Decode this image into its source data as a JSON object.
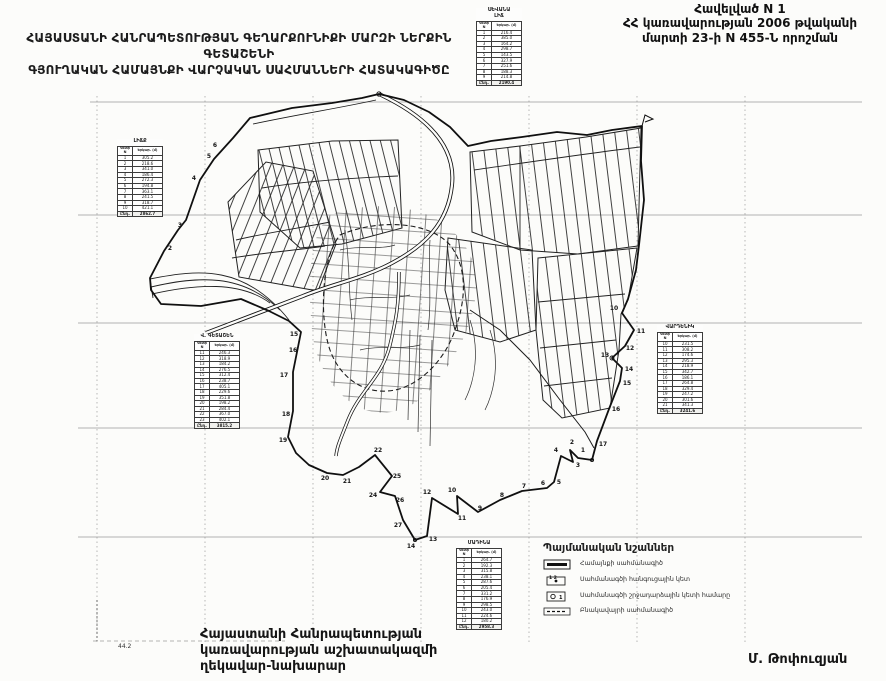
{
  "document": {
    "annex": {
      "line1": "Հավելված N 1",
      "line2": "ՀՀ կառավարության 2006 թվականի",
      "line3": "մարտի 23-ի N 455-Ն որոշման"
    },
    "title": {
      "line1": "ՀԱՅԱՍՏԱՆԻ ՀԱՆՐԱՊԵՏՈՒԹՅԱՆ ԳԵՂԱՐՔՈՒՆԻՔԻ ՄԱՐԶԻ ՆԵՐՔԻՆ ԳԵՏԱՇԵՆԻ",
      "line2": "ԳՅՈՒՂԱԿԱՆ ՀԱՄԱՅՆՔԻ ՎԱՐՉԱԿԱՆ ՍԱՀՄԱՆՆԵՐԻ ՀԱՏԱԿԱԳԻԾԸ"
    },
    "signature": {
      "line1": "Հայաստանի Հանրապետության",
      "line2": "կառավարության աշխատակազմի",
      "line3": "ղեկավար-նախարար",
      "name": "Մ. Թոփուզյան"
    },
    "scale_mark": "44.2",
    "ink_color": "#141414",
    "paper_color": "#fcfcfa",
    "grid_color": "#9a9a9a"
  },
  "legend": {
    "title": "Պայմանական նշաններ",
    "items": [
      {
        "symbol": "community-boundary-line",
        "label": "Համայնքի սահմանագիծ",
        "symbol_digits": ""
      },
      {
        "symbol": "boundary-node-point",
        "label": "Սահմանագծի հանգուցային կետ",
        "symbol_digits": "1 2"
      },
      {
        "symbol": "boundary-turn-point-number",
        "label": "Սահմանագծի շրջադարձային կետի համարը",
        "symbol_digits": "1"
      },
      {
        "symbol": "settlement-boundary-line",
        "label": "Բնակավայրի սահմանագիծ",
        "symbol_digits": ""
      }
    ]
  },
  "coordinate_tables": [
    {
      "id": "t-north",
      "x": 476,
      "y": 8,
      "title_lines": [
        "ՍԵՎԱՆԱ",
        "ԼԻՃ"
      ],
      "headers": [
        "Կետի N",
        "Երկար. (մ)"
      ],
      "rows": [
        [
          "1",
          "216.4"
        ],
        [
          "2",
          "385.0"
        ],
        [
          "3",
          "164.2"
        ],
        [
          "4",
          "298.7"
        ],
        [
          "5",
          "143.5"
        ],
        [
          "6",
          "327.9"
        ],
        [
          "7",
          "251.6"
        ],
        [
          "8",
          "188.3"
        ],
        [
          "9",
          "214.8"
        ]
      ],
      "total": [
        "Ընդ.",
        "2190.4"
      ]
    },
    {
      "id": "t-west-upper",
      "x": 117,
      "y": 139,
      "title_lines": [
        "ԼԻՃՔ"
      ],
      "headers": [
        "Կետի N",
        "Երկար. (մ)"
      ],
      "rows": [
        [
          "1",
          "305.2"
        ],
        [
          "2",
          "218.6"
        ],
        [
          "3",
          "341.0"
        ],
        [
          "4",
          "186.4"
        ],
        [
          "5",
          "272.3"
        ],
        [
          "6",
          "194.8"
        ],
        [
          "7",
          "363.1"
        ],
        [
          "8",
          "241.5"
        ],
        [
          "9",
          "318.7"
        ],
        [
          "10",
          "421.1"
        ]
      ],
      "total": [
        "Ընդ.",
        "2862.7"
      ]
    },
    {
      "id": "t-west-mid",
      "x": 194,
      "y": 334,
      "title_lines": [
        "Վ. ԳԵՏԱՇԵՆ"
      ],
      "headers": [
        "Կետի N",
        "Երկար. (մ)"
      ],
      "rows": [
        [
          "11",
          "246.3"
        ],
        [
          "12",
          "318.9"
        ],
        [
          "13",
          "184.2"
        ],
        [
          "14",
          "276.5"
        ],
        [
          "15",
          "312.4"
        ],
        [
          "16",
          "238.7"
        ],
        [
          "17",
          "405.1"
        ],
        [
          "18",
          "229.6"
        ],
        [
          "19",
          "351.8"
        ],
        [
          "20",
          "198.2"
        ],
        [
          "21",
          "284.4"
        ],
        [
          "22",
          "367.0"
        ],
        [
          "23",
          "402.1"
        ]
      ],
      "total": [
        "Ընդ.",
        "3815.2"
      ]
    },
    {
      "id": "t-east",
      "x": 657,
      "y": 325,
      "title_lines": [
        "ՎԱՐԴԵՆԻԿ"
      ],
      "headers": [
        "Կետի N",
        "Երկար. (մ)"
      ],
      "rows": [
        [
          "10",
          "231.5"
        ],
        [
          "11",
          "308.2"
        ],
        [
          "12",
          "174.6"
        ],
        [
          "13",
          "295.3"
        ],
        [
          "14",
          "218.9"
        ],
        [
          "15",
          "342.7"
        ],
        [
          "16",
          "186.1"
        ],
        [
          "17",
          "264.8"
        ],
        [
          "18",
          "329.4"
        ],
        [
          "19",
          "247.2"
        ],
        [
          "20",
          "301.6"
        ],
        [
          "21",
          "341.3"
        ]
      ],
      "total": [
        "Ընդ.",
        "3241.6"
      ]
    },
    {
      "id": "t-south",
      "x": 456,
      "y": 541,
      "title_lines": [
        "ՄԱԴԻՆԱ"
      ],
      "headers": [
        "Կետի N",
        "Երկար. (մ)"
      ],
      "rows": [
        [
          "1",
          "264.7"
        ],
        [
          "2",
          "192.3"
        ],
        [
          "3",
          "315.8"
        ],
        [
          "4",
          "238.1"
        ],
        [
          "5",
          "287.6"
        ],
        [
          "6",
          "205.4"
        ],
        [
          "7",
          "331.2"
        ],
        [
          "8",
          "176.9"
        ],
        [
          "9",
          "298.5"
        ],
        [
          "10",
          "243.0"
        ],
        [
          "11",
          "224.6"
        ],
        [
          "12",
          "180.2"
        ]
      ],
      "total": [
        "Ընդ.",
        "2958.3"
      ]
    }
  ],
  "boundary_point_labels": [
    {
      "n": "1",
      "x": 583,
      "y": 452
    },
    {
      "n": "2",
      "x": 572,
      "y": 444
    },
    {
      "n": "3",
      "x": 578,
      "y": 467
    },
    {
      "n": "4",
      "x": 556,
      "y": 452
    },
    {
      "n": "5",
      "x": 559,
      "y": 484
    },
    {
      "n": "6",
      "x": 543,
      "y": 485
    },
    {
      "n": "7",
      "x": 524,
      "y": 488
    },
    {
      "n": "8",
      "x": 502,
      "y": 497
    },
    {
      "n": "9",
      "x": 480,
      "y": 510
    },
    {
      "n": "10",
      "x": 452,
      "y": 492
    },
    {
      "n": "11",
      "x": 462,
      "y": 520
    },
    {
      "n": "12",
      "x": 427,
      "y": 494
    },
    {
      "n": "13",
      "x": 433,
      "y": 541
    },
    {
      "n": "14",
      "x": 411,
      "y": 548
    },
    {
      "n": "27",
      "x": 398,
      "y": 527
    },
    {
      "n": "26",
      "x": 400,
      "y": 502
    },
    {
      "n": "24",
      "x": 373,
      "y": 497
    },
    {
      "n": "25",
      "x": 397,
      "y": 478
    },
    {
      "n": "22",
      "x": 378,
      "y": 452
    },
    {
      "n": "21",
      "x": 347,
      "y": 483
    },
    {
      "n": "20",
      "x": 325,
      "y": 480
    },
    {
      "n": "19",
      "x": 283,
      "y": 442
    },
    {
      "n": "18",
      "x": 286,
      "y": 416
    },
    {
      "n": "17",
      "x": 284,
      "y": 377
    },
    {
      "n": "16",
      "x": 293,
      "y": 352
    },
    {
      "n": "15",
      "x": 294,
      "y": 336
    },
    {
      "n": "10",
      "x": 614,
      "y": 310
    },
    {
      "n": "11",
      "x": 641,
      "y": 333
    },
    {
      "n": "12",
      "x": 630,
      "y": 350
    },
    {
      "n": "13",
      "x": 605,
      "y": 357
    },
    {
      "n": "14",
      "x": 629,
      "y": 371
    },
    {
      "n": "15",
      "x": 627,
      "y": 385
    },
    {
      "n": "16",
      "x": 616,
      "y": 411
    },
    {
      "n": "17",
      "x": 603,
      "y": 446
    },
    {
      "n": "2",
      "x": 170,
      "y": 250
    },
    {
      "n": "3",
      "x": 180,
      "y": 227
    },
    {
      "n": "4",
      "x": 194,
      "y": 180
    },
    {
      "n": "5",
      "x": 209,
      "y": 158
    },
    {
      "n": "6",
      "x": 215,
      "y": 147
    }
  ]
}
